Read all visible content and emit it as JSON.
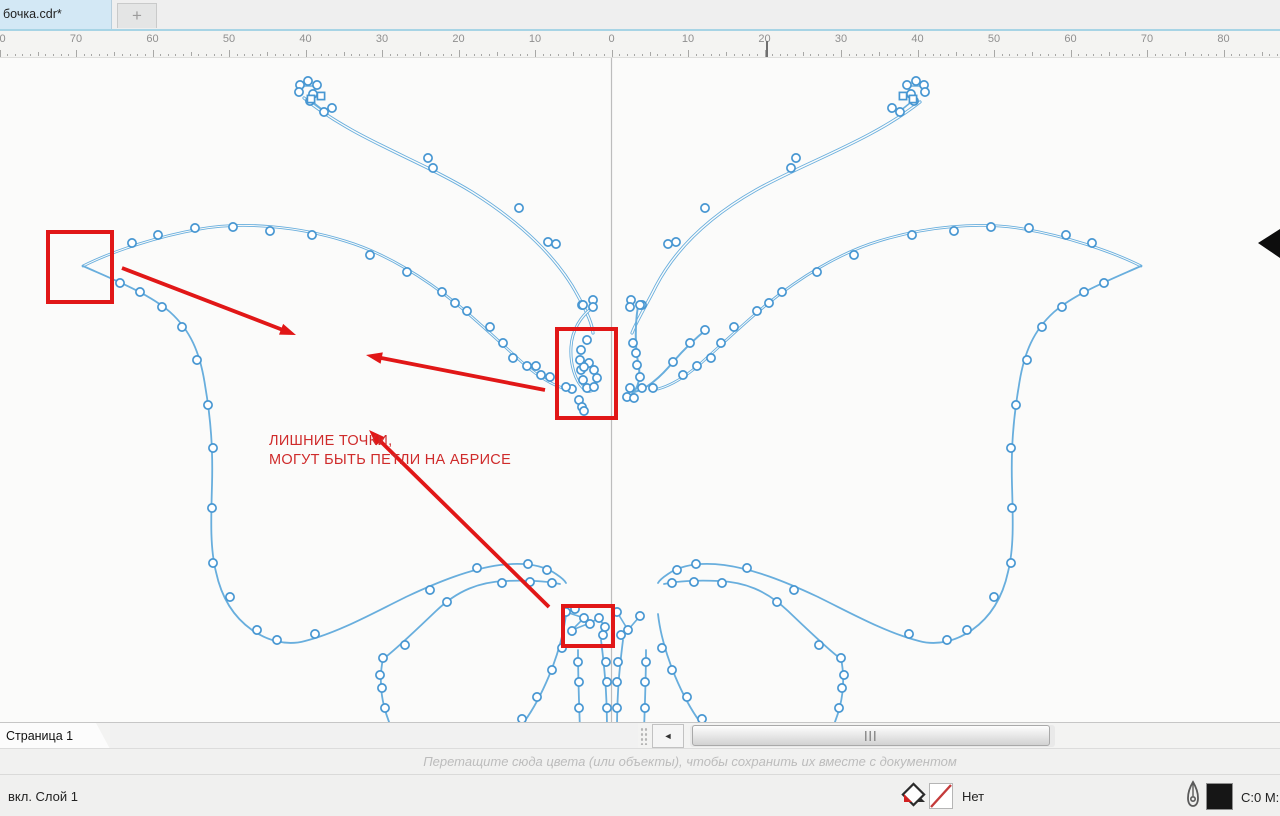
{
  "tabbar": {
    "document_tab": "бочка.cdr*",
    "new_tab_label": "+"
  },
  "ruler": {
    "labels": [
      "80",
      "70",
      "60",
      "50",
      "40",
      "30",
      "20",
      "10",
      "0",
      "10",
      "20",
      "30",
      "40",
      "50",
      "60",
      "70",
      "80"
    ],
    "origin_px": 611.5,
    "major_step_px": 76.5
  },
  "canvas": {
    "annotation_line1": "ЛИШНИЕ ТОЧКИ,",
    "annotation_line2": "МОГУТ БЫТЬ ПЕТЛИ НА АБРИСЕ"
  },
  "pagebar": {
    "page_tab": "Страница 1",
    "scroll_left_glyph": "◄"
  },
  "hintbar": {
    "text": "Перетащите сюда цвета (или объекты), чтобы сохранить их вместе с документом"
  },
  "statusbar": {
    "layer_label": "вкл. Слой 1",
    "fill_none_label": "Нет",
    "outline_value": "C:0 M:"
  },
  "icons": {
    "fill_indicator": "fill-diamond-icon",
    "no_fill": "no-fill-swatch",
    "outline_pen": "pen-nib-icon",
    "cursor": "black-arrow-cursor"
  },
  "colors": {
    "curve_blue": "#68aedd",
    "node_stroke": "#4897d2",
    "node_fill": "#ffffff",
    "annotation_red": "#e11717",
    "annotation_text_red": "#cf2b2b",
    "guideline_gray": "#bdbdbd",
    "canvas_bg": "#fbfbfa"
  }
}
